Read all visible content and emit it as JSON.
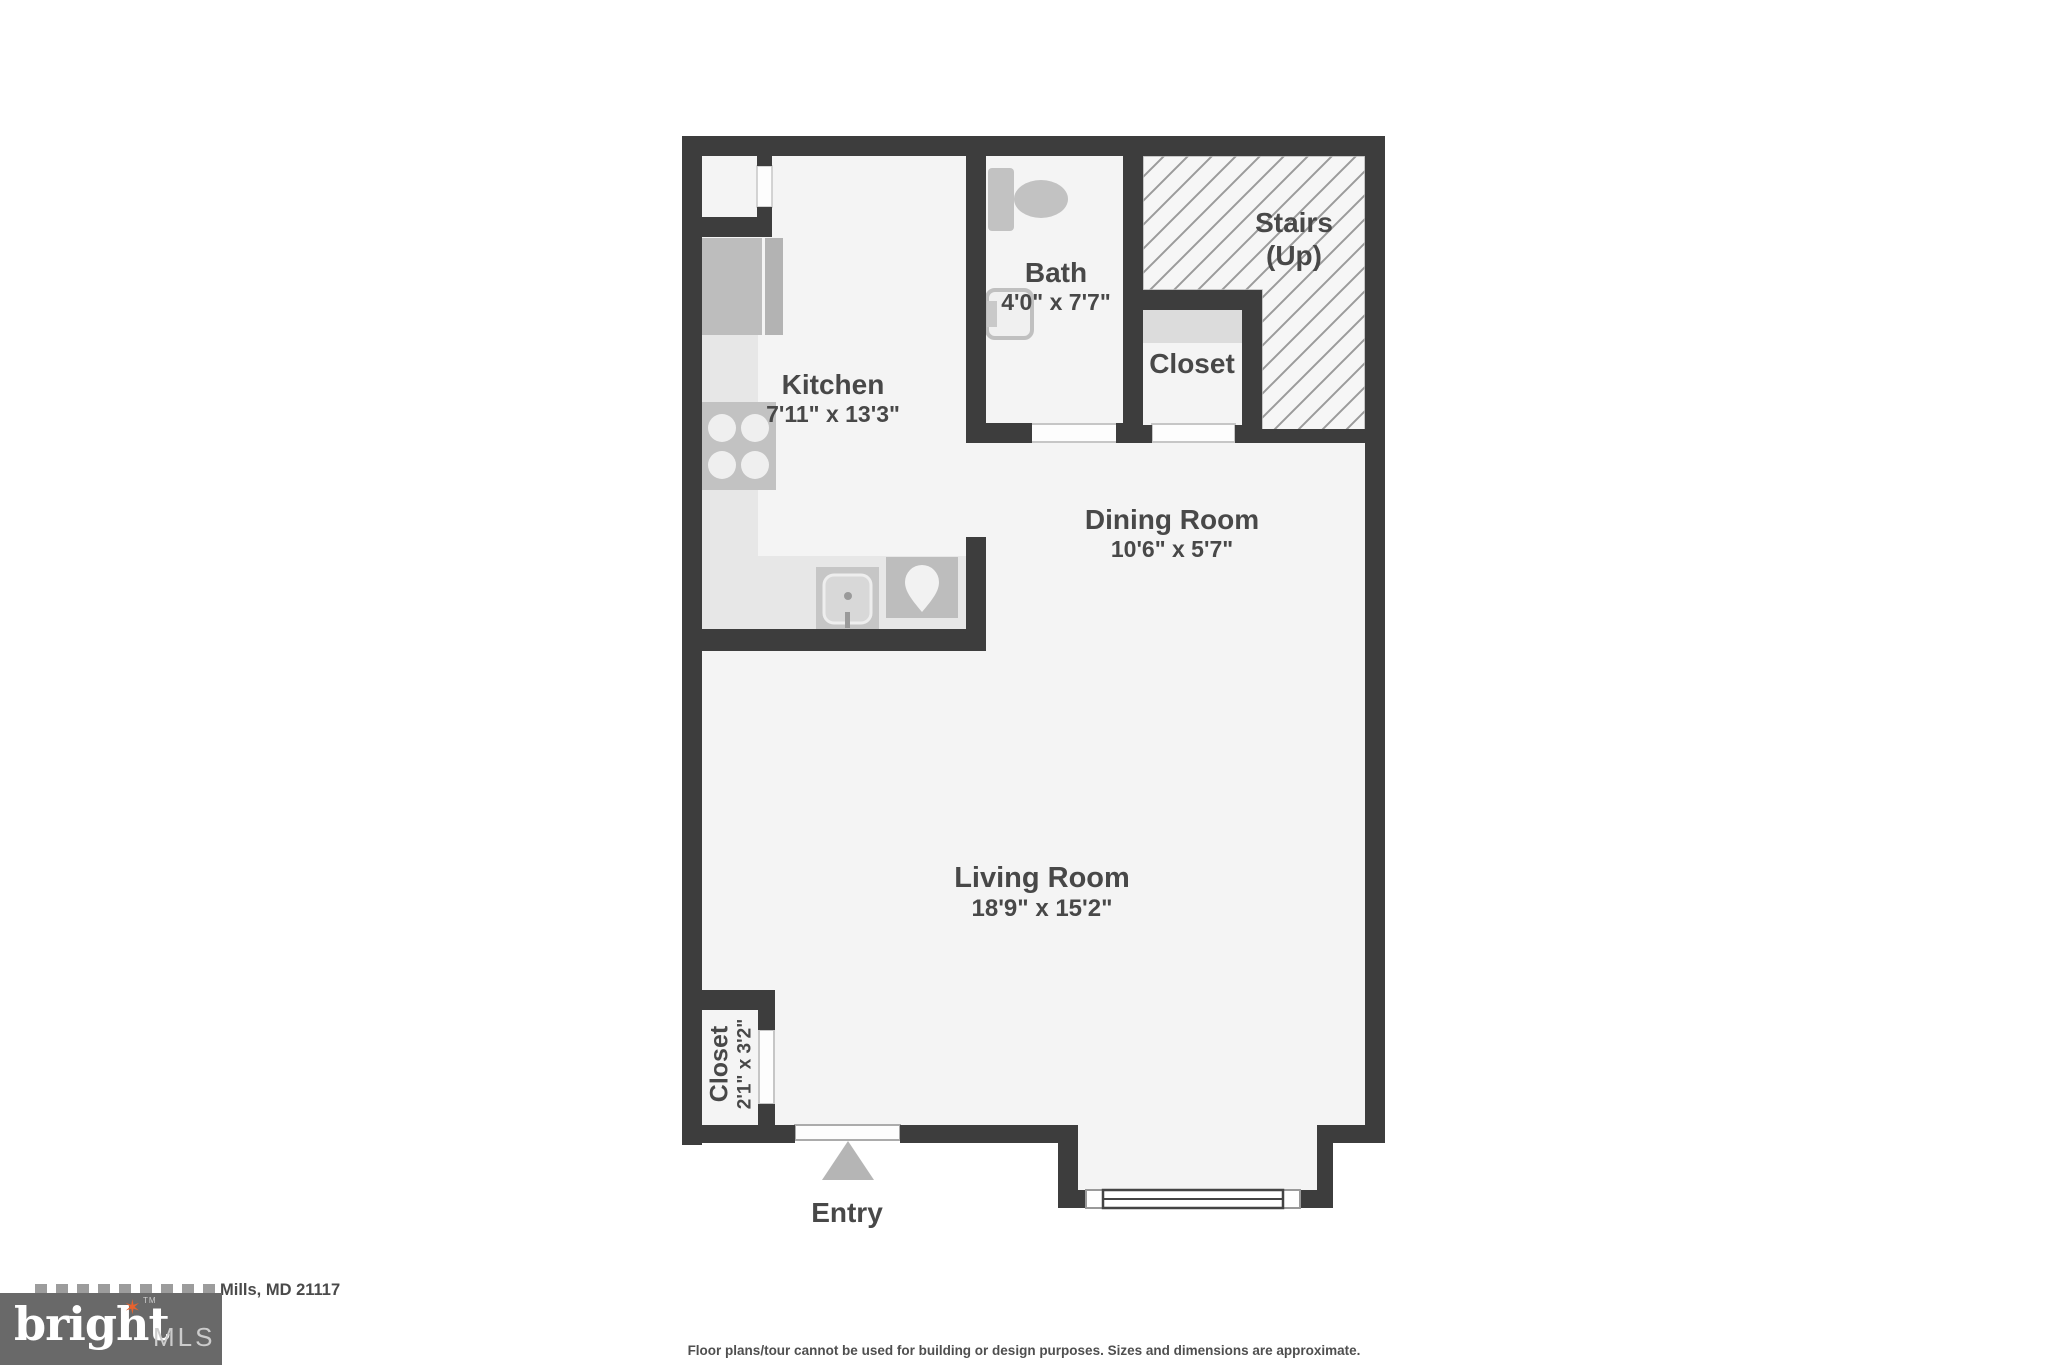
{
  "floorplan": {
    "rooms": {
      "kitchen": {
        "label": "Kitchen",
        "dimensions": "7'11\" x 13'3\""
      },
      "bath": {
        "label": "Bath",
        "dimensions": "4'0\" x 7'7\""
      },
      "stairs": {
        "label": "Stairs",
        "sublabel": "(Up)"
      },
      "closet_upper": {
        "label": "Closet"
      },
      "dining_room": {
        "label": "Dining Room",
        "dimensions": "10'6\" x 5'7\""
      },
      "living_room": {
        "label": "Living Room",
        "dimensions": "18'9\" x 15'2\""
      },
      "closet_entry": {
        "label": "Closet",
        "dimensions": "2'1\" x 3'2\""
      },
      "entry": {
        "label": "Entry"
      }
    },
    "icons": {
      "stove": "stove-burners-icon",
      "refrigerator": "refrigerator-icon",
      "dishwasher": "dishwasher-icon",
      "kitchen_sink": "sink-drop-icon",
      "toilet": "toilet-icon",
      "bath_sink": "bathroom-sink-icon",
      "entry_arrow": "entry-direction-arrow",
      "window": "window-symbol",
      "stairs_hatch": "stairs-hatch-pattern"
    },
    "colors": {
      "wall": "#3d3d3d",
      "floor": "#f4f4f4",
      "fixture": "#c2c2c2",
      "counter": "#e7e7e7",
      "hatch_line": "#9b9b9b",
      "label_text": "#484848"
    }
  },
  "footer": {
    "address_visible": "Mills, MD 21117",
    "disclaimer": "Floor plans/tour cannot be used for building or design purposes. Sizes and dimensions are approximate.",
    "logo": {
      "brand": "bright",
      "tm": "TM",
      "suffix": "MLS",
      "background": "#696969",
      "star_color": "#e8622d"
    }
  }
}
